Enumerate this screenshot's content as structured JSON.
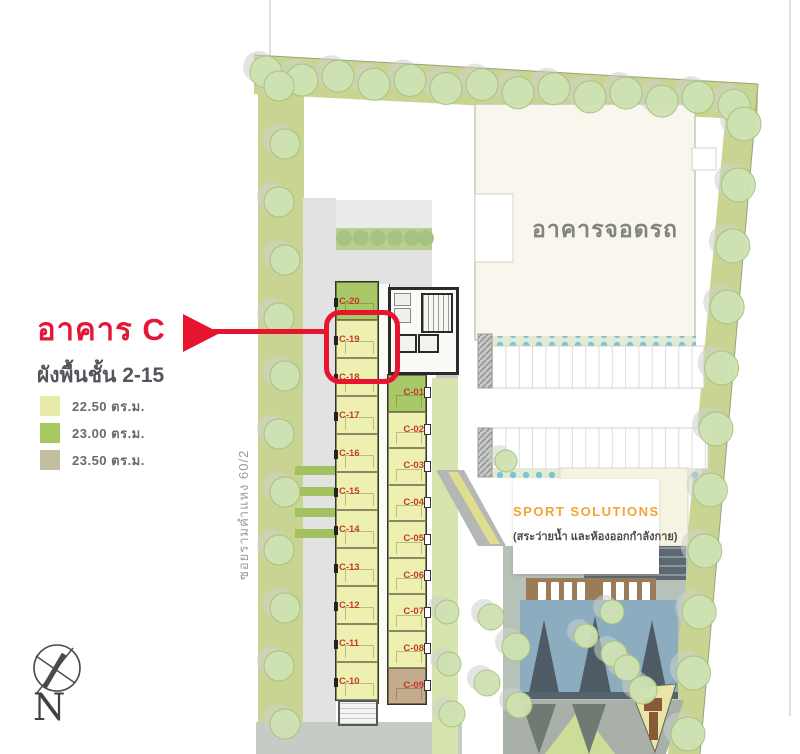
{
  "callout": {
    "title": "อาคาร C",
    "subtitle": "ผังพื้นชั้น 2-15",
    "accent_color": "#e8142f"
  },
  "legend": [
    {
      "label": "22.50 ตร.ม.",
      "color": "#e7eaa8",
      "key": "22.50"
    },
    {
      "label": "23.00 ตร.ม.",
      "color": "#a7c85f",
      "key": "23.00"
    },
    {
      "label": "23.50 ตร.ม.",
      "color": "#c2bd9e",
      "key": "23.50"
    }
  ],
  "compass": {
    "label": "N"
  },
  "plan": {
    "road_label": "ซอยรามคำแหง 60/2",
    "parking_label": "อาคารจอดรถ",
    "sport_card": {
      "title": "SPORT SOLUTIONS",
      "subtitle": "(สระว่ายน้ำ และห้องออกกำลังกาย)"
    },
    "highlighted_unit": "C-19",
    "unit_label_color": "#bf3c2a",
    "size_colors": {
      "22.50": "#eef0af",
      "23.00": "#a9c868",
      "23.50": "#c3ab8c"
    },
    "tower": {
      "left_units": [
        {
          "id": "C-20",
          "size": "23.00"
        },
        {
          "id": "C-19",
          "size": "22.50"
        },
        {
          "id": "C-18",
          "size": "22.50"
        },
        {
          "id": "C-17",
          "size": "22.50"
        },
        {
          "id": "C-16",
          "size": "22.50"
        },
        {
          "id": "C-15",
          "size": "22.50"
        },
        {
          "id": "C-14",
          "size": "22.50"
        },
        {
          "id": "C-13",
          "size": "22.50"
        },
        {
          "id": "C-12",
          "size": "22.50"
        },
        {
          "id": "C-11",
          "size": "22.50"
        },
        {
          "id": "C-10",
          "size": "22.50"
        }
      ],
      "right_units": [
        {
          "id": "C-01",
          "size": "23.00"
        },
        {
          "id": "C-02",
          "size": "22.50"
        },
        {
          "id": "C-03",
          "size": "22.50"
        },
        {
          "id": "C-04",
          "size": "22.50"
        },
        {
          "id": "C-05",
          "size": "22.50"
        },
        {
          "id": "C-06",
          "size": "22.50"
        },
        {
          "id": "C-07",
          "size": "22.50"
        },
        {
          "id": "C-08",
          "size": "22.50"
        },
        {
          "id": "C-09",
          "size": "23.50"
        }
      ]
    }
  }
}
